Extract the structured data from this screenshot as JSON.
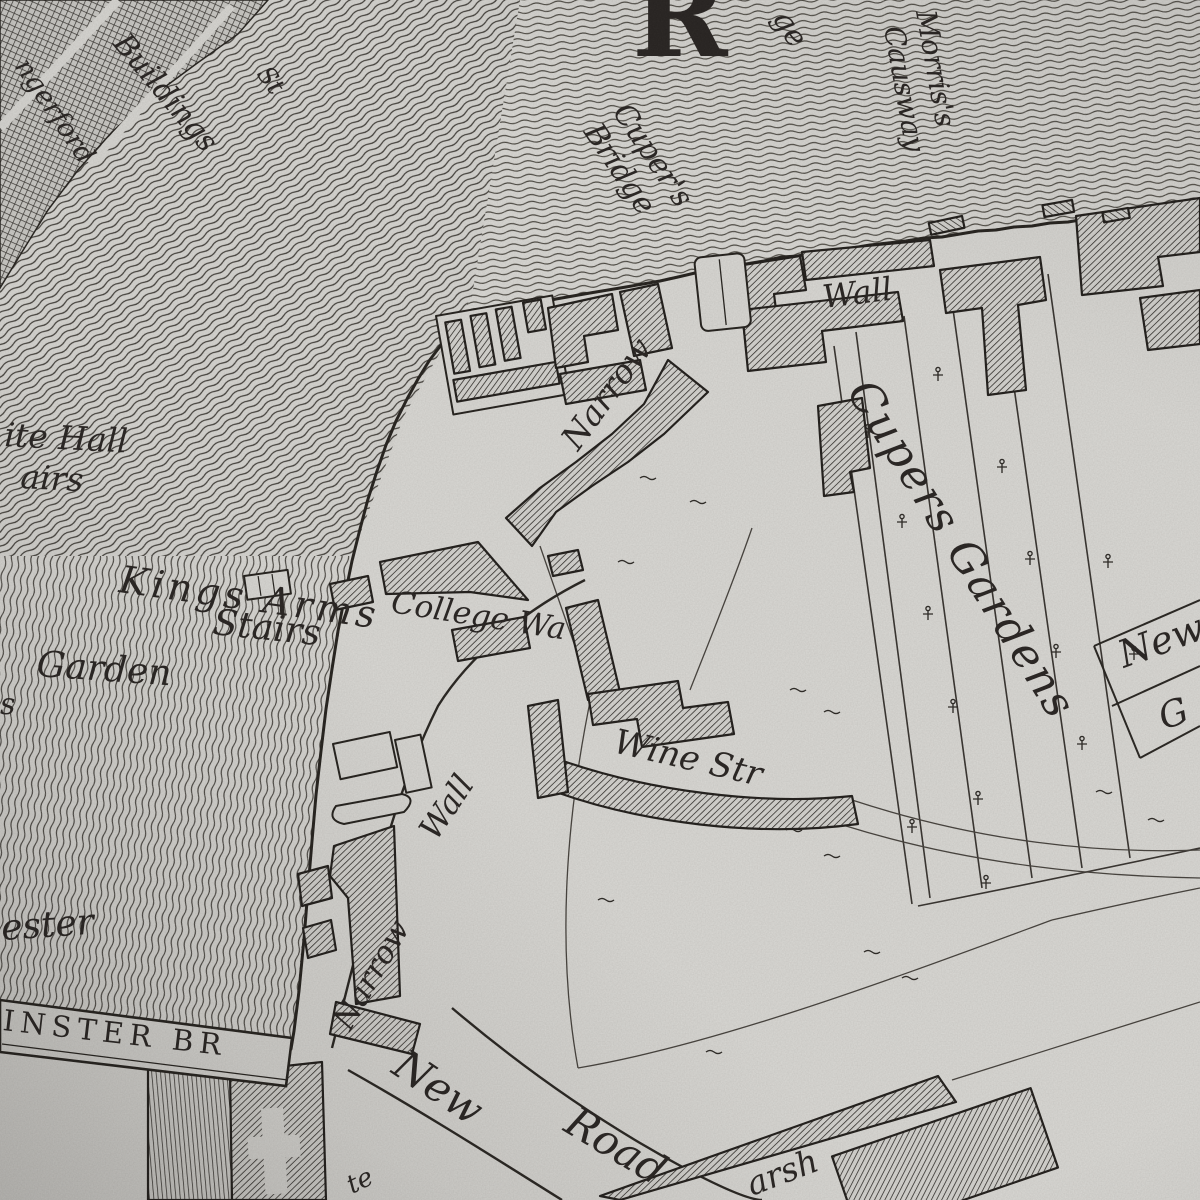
{
  "colors": {
    "paper": "#dad9d5",
    "ink": "#24211d",
    "water_line": "#4a4743",
    "hatch": "#2f2c29"
  },
  "labels": {
    "buildings": "Buildings",
    "hungerford": "ngerford",
    "street_fragment": "St",
    "river_initial": "R",
    "bridge_fragment": "ge",
    "cupers_bridge_line1": "Cuper's",
    "cupers_bridge_line2": "Bridge",
    "morris_line1": "Morris's",
    "morris_line2": "Causway",
    "whitehall_line1": "ite Hall",
    "whitehall_line2": "airs",
    "kings_arms_line1": "Kings Arms",
    "kings_arms_line2": "Stairs",
    "garden": "Garden",
    "garden_fragment_s": "s",
    "ester_fragment": "ester",
    "westminster_bridge": "INSTER BR",
    "wall_shore": "Wall",
    "narrow_street": "Narrow",
    "cupers_gardens": "Cupers Gardens",
    "college_walk": "College Wa",
    "wine_street": "Wine Str",
    "narrow_wall_wall": "Wall",
    "narrow_wall_narrow": "Narrow",
    "new_road_new": "New",
    "new_road_road": "Road",
    "marsh_fragment": "arsh",
    "te_fragment": "te",
    "panel_new": "New",
    "panel_g": "G"
  }
}
